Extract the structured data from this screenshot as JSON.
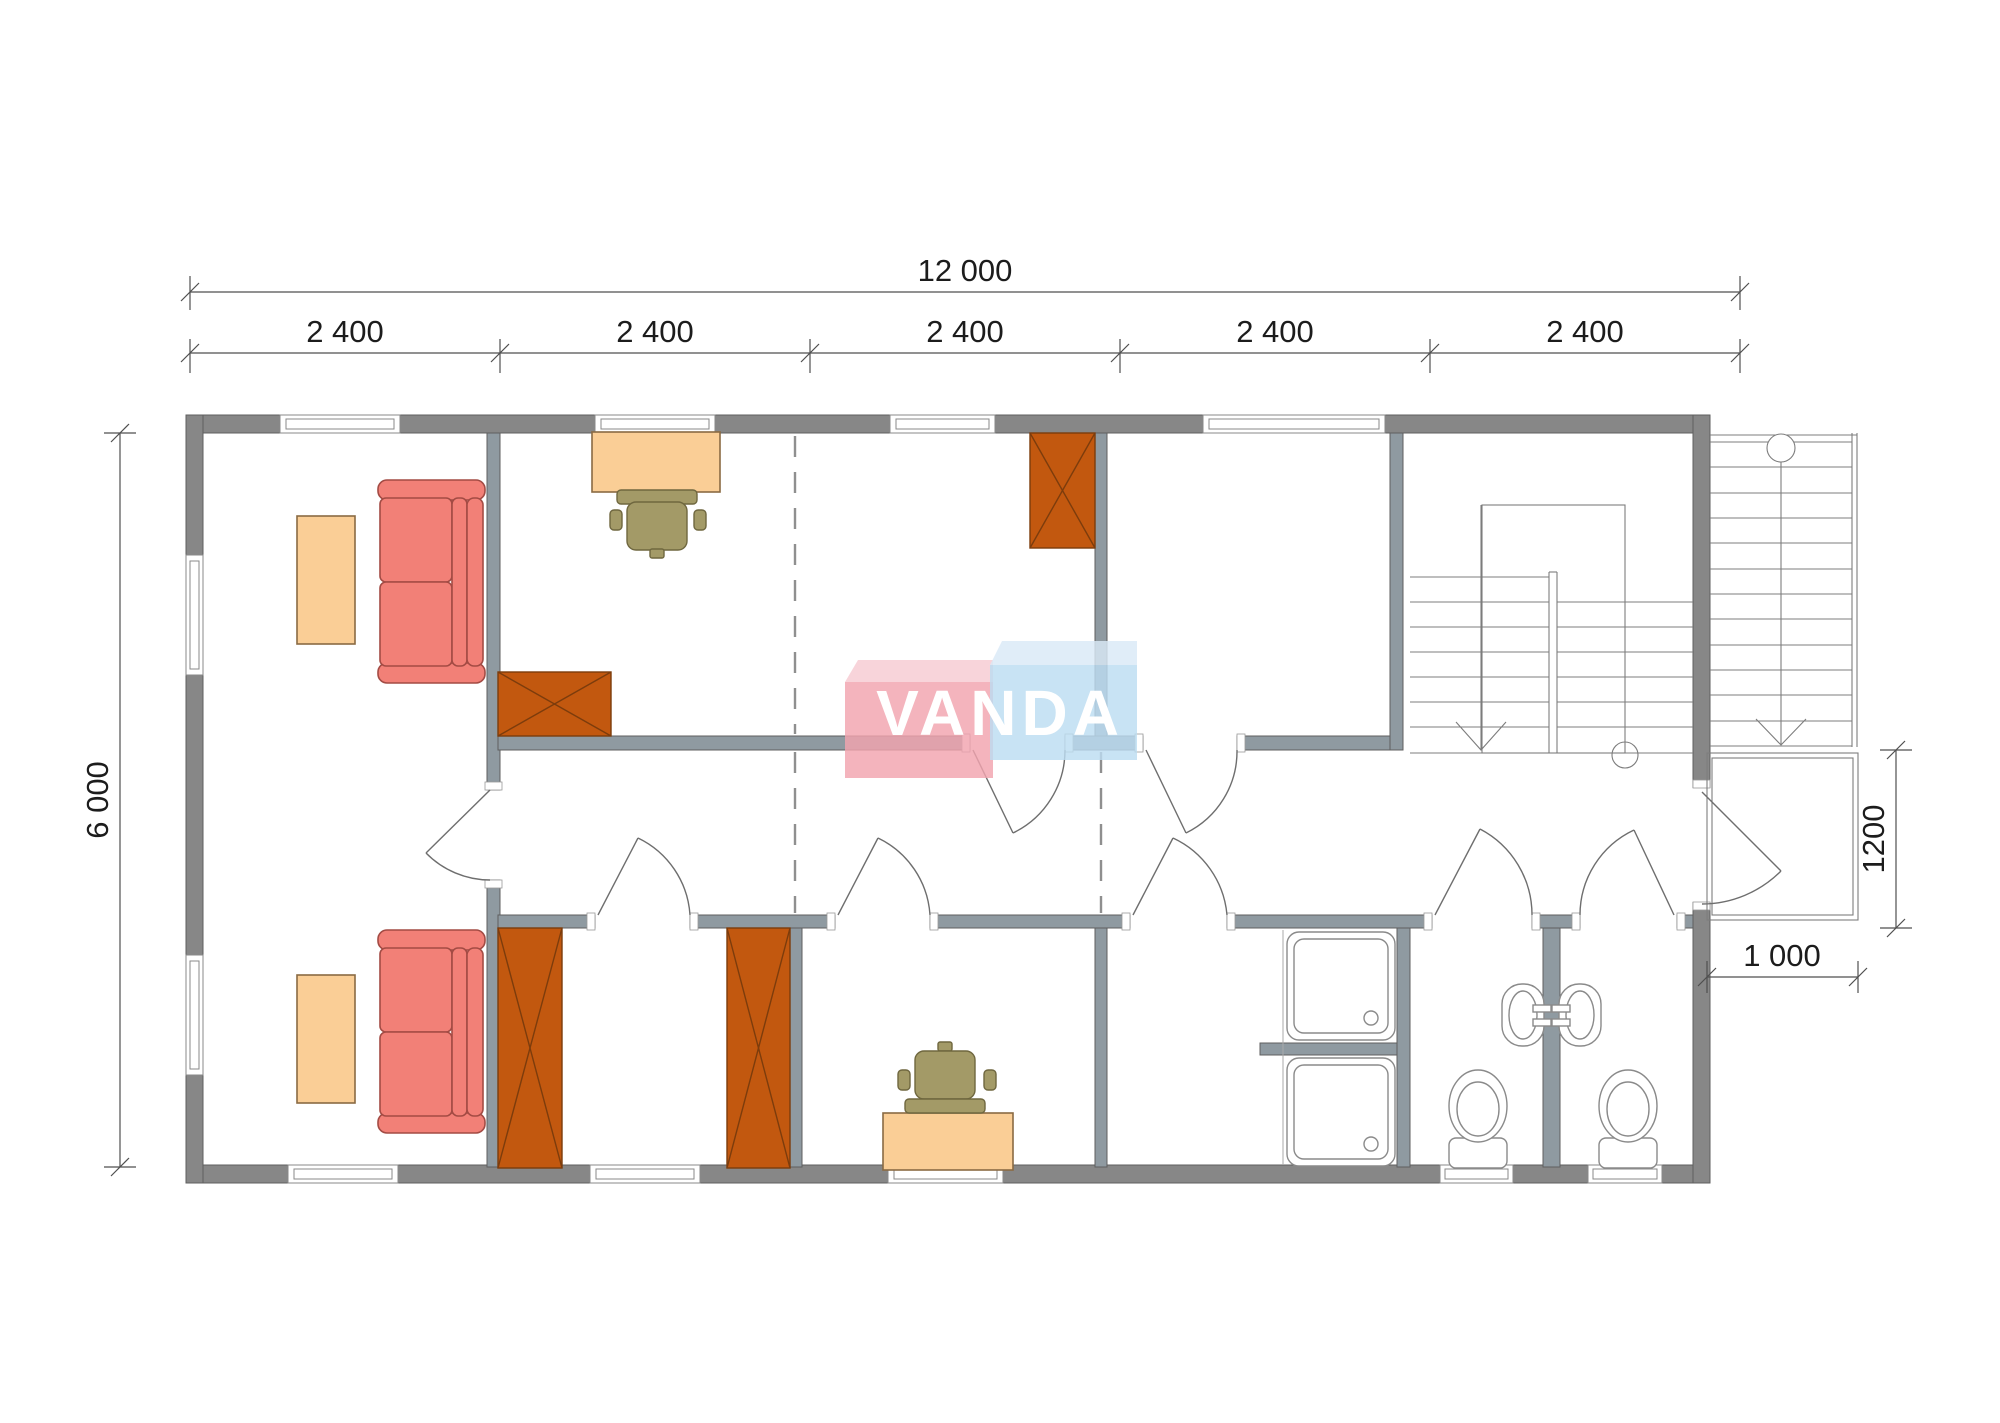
{
  "page": {
    "kind": "architectural-floor-plan",
    "background": "#ffffff"
  },
  "watermark": {
    "text": "VANDA",
    "box_pink": "#F2A4AF",
    "box_pink_top": "#F7CBD3",
    "box_blue": "#BDDDF2",
    "box_blue_top": "#DAEAF7",
    "text_color": "#ffffff"
  },
  "dimensions": {
    "overall_width": "12 000",
    "bay_widths": [
      "2 400",
      "2 400",
      "2 400",
      "2 400",
      "2 400"
    ],
    "overall_depth": "6 000",
    "porch_depth": "1200",
    "porch_width": "1 000"
  },
  "palette": {
    "exterior_wall": "#878787",
    "interior_wall": "#8F9AA1",
    "sofa": "#F28077",
    "sofa_edge": "#A34B44",
    "table": "#FACE96",
    "table_edge": "#8A6A43",
    "chair": "#A39A67",
    "chair_edge": "#6F673F",
    "wardrobe": "#C2580F",
    "wardrobe_edge": "#7C3C0C",
    "drawing_lines": "#6E6E6E"
  },
  "inventory": {
    "rooms": [
      "living-room",
      "office-room",
      "bedroom-top-right",
      "stair-hall",
      "bedroom-bottom-wardrobes",
      "bedroom-bottom-desk",
      "shower-room",
      "wc-1",
      "wc-2",
      "corridor",
      "porch"
    ],
    "furniture": [
      "sofa x2",
      "coffee-table x2",
      "desk-with-chair x2",
      "wardrobe x4",
      "shower-tray x2",
      "toilet x2",
      "wash-basin x2",
      "interior-stair",
      "exterior-stair"
    ]
  }
}
